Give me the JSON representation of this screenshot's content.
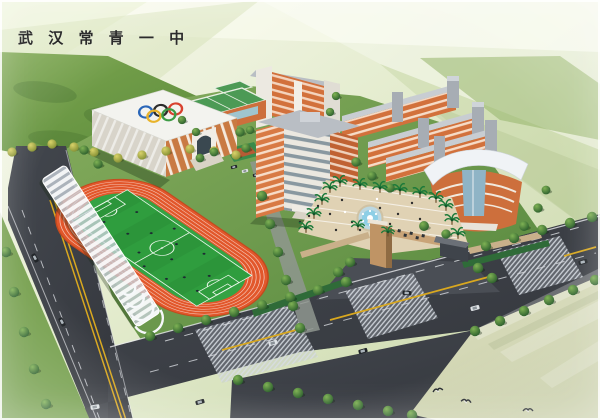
{
  "header": {
    "title": "武 汉 常 青 一 中"
  },
  "palette": {
    "title_text": "#2b2b2b",
    "background_top": "#f8f9ee",
    "background_green": "#cbd9ae",
    "campus_lawn": "#6a9a4a",
    "track_surface": "#e2572b",
    "soccer_pitch": "#2f9d3e",
    "road_asphalt": "#3c4046",
    "road_marking_yellow": "#d9a81f",
    "road_marking_white": "#d7dade",
    "building_orange": "#cd6f3c",
    "roof_white": "#f1f2ee",
    "roof_green": "#4c9a55",
    "plaza_paving": "#e0d2b4",
    "fountain_water": "#8ecfe6",
    "gate_tan": "#c9a478",
    "canopy_white": "#f6f8fa",
    "olympic_blue": "#2a66b8",
    "olympic_black": "#2b2b2b",
    "olympic_red": "#d8422f",
    "olympic_yellow": "#e8b32a",
    "olympic_green": "#3d9b45"
  }
}
